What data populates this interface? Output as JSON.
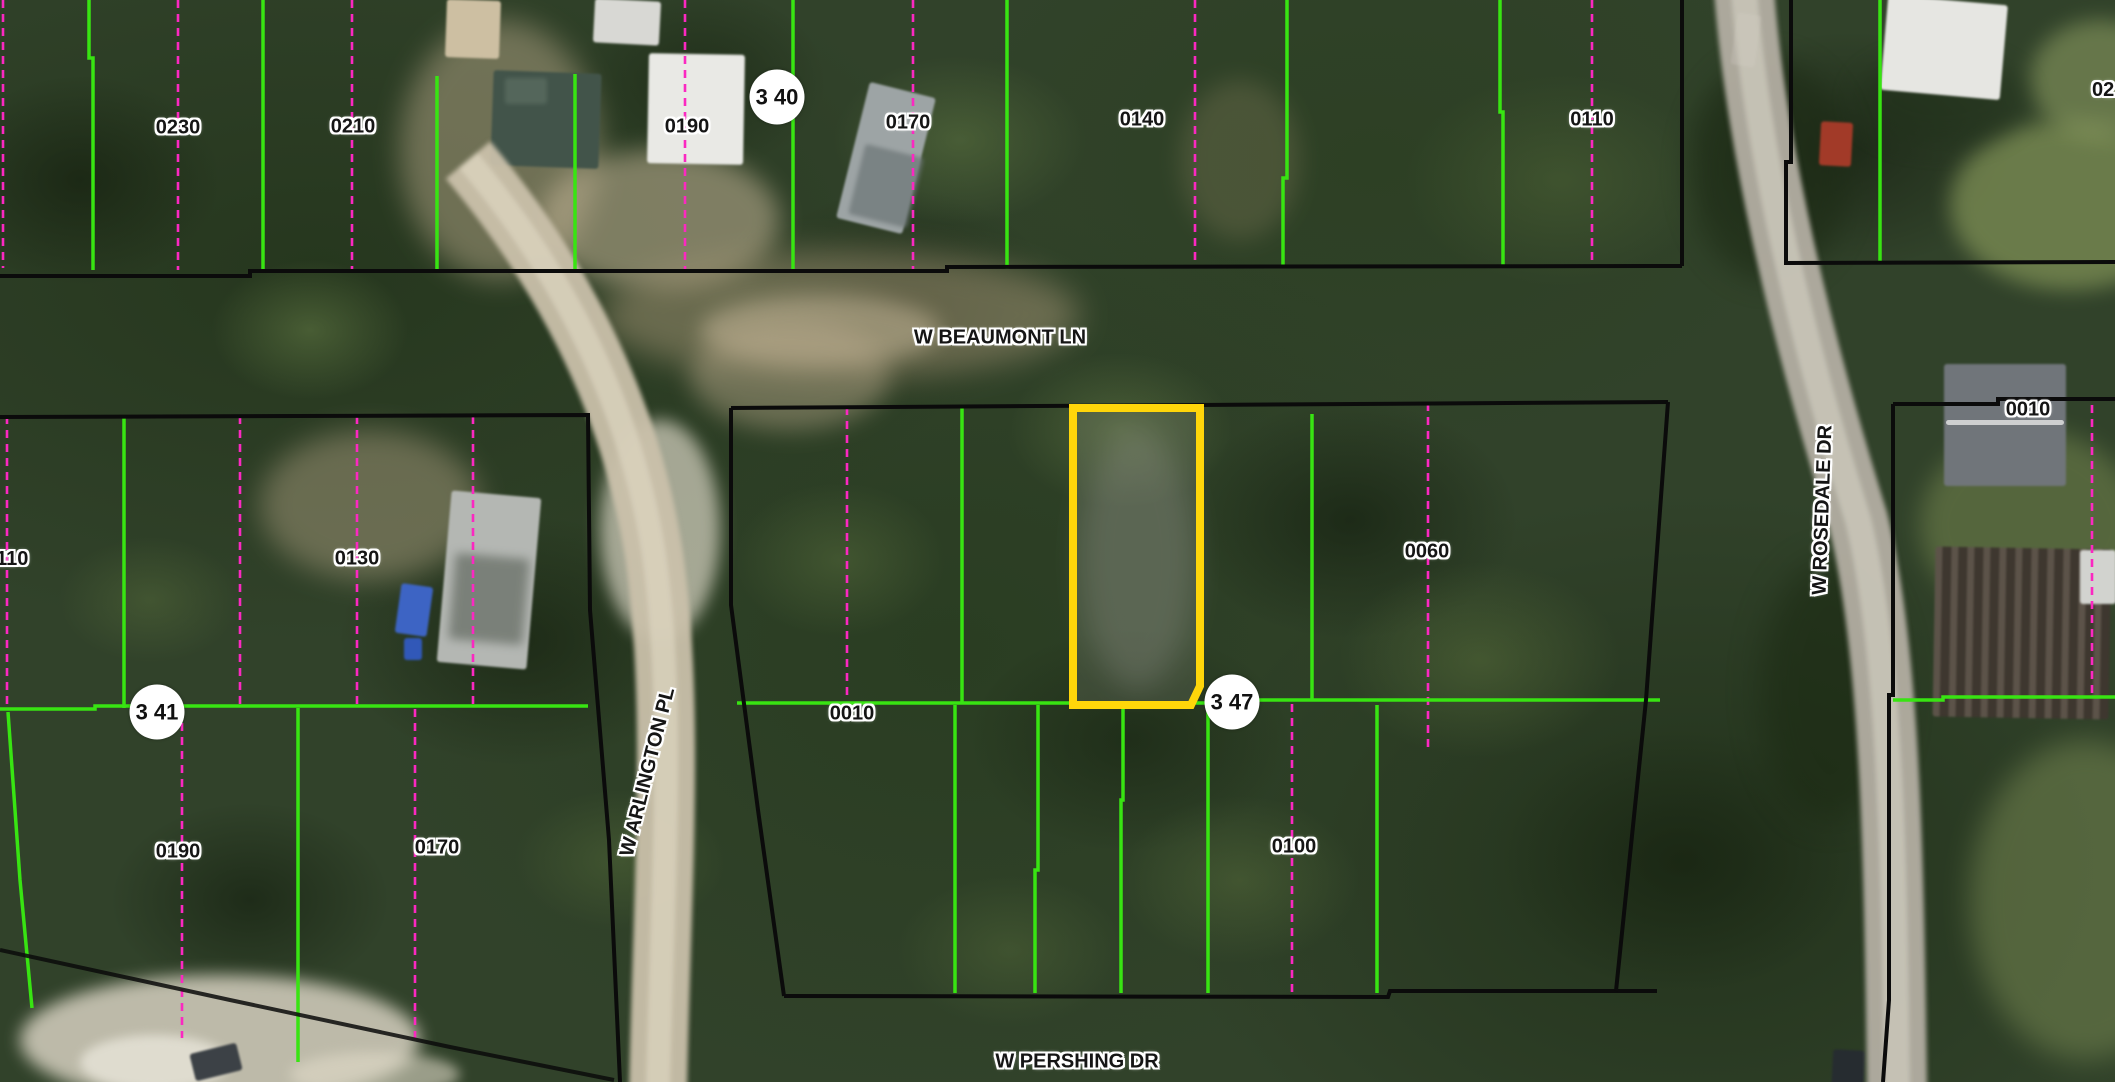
{
  "map": {
    "streets": {
      "beaumont": "W BEAUMONT LN",
      "arlington": "W ARLINGTON PL",
      "rosedale": "W ROSEDALE DR",
      "pershing": "W PERSHING DR"
    },
    "blocks": {
      "top_left": {
        "p0230": "0230",
        "p0210": "0210",
        "p0190": "0190",
        "p0170": "0170",
        "p0140": "0140",
        "p0110": "0110"
      },
      "top_right": {
        "partial_right": "02"
      },
      "mid_left": {
        "p0110_partial": "0110",
        "p0130": "0130",
        "p0190": "0190",
        "p0170": "0170"
      },
      "middle": {
        "p0010": "0010",
        "p0060": "0060",
        "p0100": "0100"
      },
      "right": {
        "p0010": "0010"
      }
    },
    "badges": {
      "b340": "3 40",
      "b341": "3 41",
      "b347": "3 47"
    },
    "highlighted_parcel": {
      "outline_color": "#FFD60A"
    },
    "line_colors": {
      "block_boundary": "#0B0B0B",
      "parcel_line_green": "#38E412",
      "lot_line_pink": "#FB28C1"
    }
  }
}
